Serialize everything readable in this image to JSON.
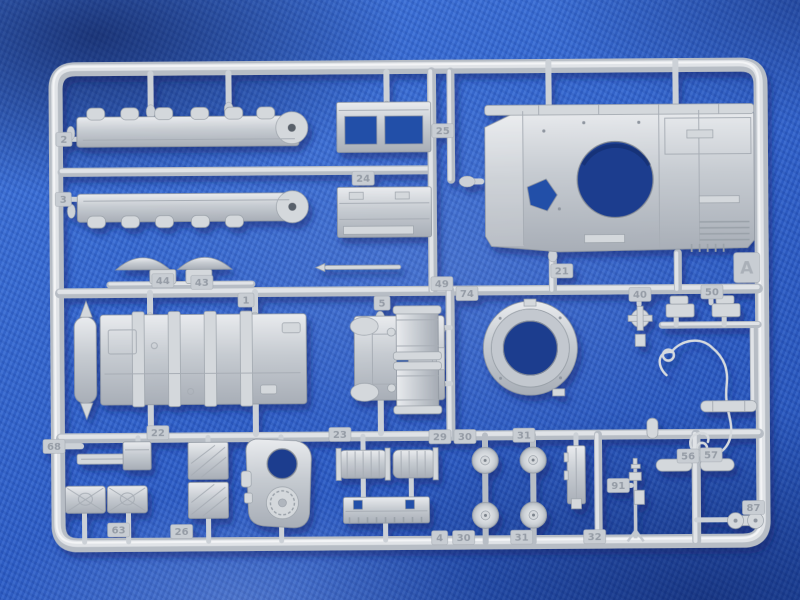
{
  "scene": {
    "type": "photograph",
    "subject": "Gray injection-molded styrene model kit sprue (parts tree), runner letter A, from an armored vehicle / tank model kit, photographed lying on blue woven fabric",
    "sprue_letter": "A",
    "colors": {
      "plastic": "#c9ced4",
      "plastic_highlight": "#eceef0",
      "plastic_shadow": "#9298a1",
      "fabric_blue": "#2e5fc7",
      "fabric_shadow": "#16337a"
    },
    "parts_visible": [
      "two long fender strips with stowage bumps (parts 2 and 3)",
      "rectangular stowage box and open frame box (parts 24 and 25)",
      "tank upper hull with circular turret ring opening and hatch cutout",
      "two dome-shaped covers (parts 44 and 43)",
      "large ribbed engine access panel with end roller (part 1)",
      "flat mounting bracket (part 5)",
      "two external fuel drums (near tags 49 and 74)",
      "circular turret ring race (part 21)",
      "turret roof piece with two round openings",
      "two ribbed cylinder halves and an intake grille plate",
      "four road wheels (parts 30 and 31)",
      "two jerry cans (part 63) and hatched stowage bins (part 26)",
      "anti-aircraft machine gun (part 91)",
      "tow cable with eye loops",
      "periscopes, rollers and small fittings (tags 40, 50, 56, 57, 87, 32, 4, 22, 23, 29, 68)"
    ]
  },
  "tags": [
    {
      "label": "2"
    },
    {
      "label": "3"
    },
    {
      "label": "24"
    },
    {
      "label": "25"
    },
    {
      "label": "21"
    },
    {
      "label": "A"
    },
    {
      "label": "44"
    },
    {
      "label": "43"
    },
    {
      "label": "1"
    },
    {
      "label": "5"
    },
    {
      "label": "49"
    },
    {
      "label": "74"
    },
    {
      "label": "40"
    },
    {
      "label": "50"
    },
    {
      "label": "68"
    },
    {
      "label": "22"
    },
    {
      "label": "23"
    },
    {
      "label": "29"
    },
    {
      "label": "30"
    },
    {
      "label": "31"
    },
    {
      "label": "56"
    },
    {
      "label": "57"
    },
    {
      "label": "91"
    },
    {
      "label": "87"
    },
    {
      "label": "63"
    },
    {
      "label": "26"
    },
    {
      "label": "4"
    },
    {
      "label": "30"
    },
    {
      "label": "31"
    },
    {
      "label": "32"
    }
  ]
}
